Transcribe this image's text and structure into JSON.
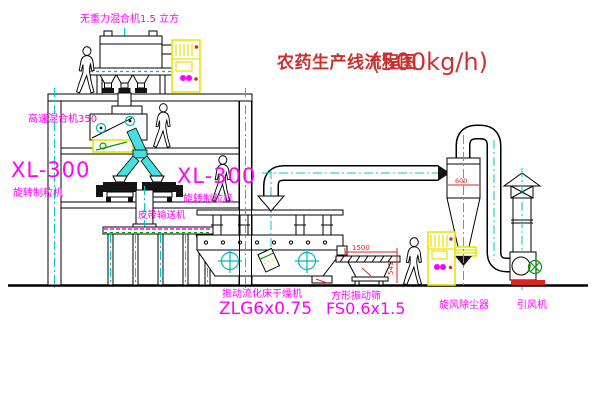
{
  "title": {
    "text": "农药生产线流程图",
    "capacity": "(500kg/h)"
  },
  "equipment": {
    "gravity_mixer_label": "无重力混合机1.5 立方",
    "high_speed_mixer_label": "高速混合机350",
    "granulator_left": {
      "model": "XL-300",
      "name": "旋转制粒机"
    },
    "granulator_right": {
      "model": "XL-300",
      "name": "旋转制粒机"
    },
    "belt_conveyor_label": "皮带输送机",
    "fluid_bed_dryer": {
      "name": "振动流化床干燥机",
      "model": "ZLG6x0.75"
    },
    "vibrating_screen": {
      "name": "方形振动筛",
      "model": "FS0.6x1.5"
    },
    "cyclone_label": "旋风除尘器",
    "fan_label": "引风机"
  },
  "dimensions": {
    "screen_length": "1500",
    "screen_height": "541",
    "cyclone_width": "600"
  },
  "icons": {
    "person": "person-silhouette-icon",
    "cabinet_symbol": "motor-coil-icon",
    "crosshair": "vibration-motor-crosshair-icon"
  },
  "colors": {
    "background": "#ffffff",
    "line": "#000000",
    "label_magenta": "#ff00ff",
    "title_red": "#cc3030",
    "dimension_red": "#e02222",
    "centerline_cyan": "#00c8c8",
    "chute_cyan": "#46dede",
    "cabinet_yellow": "#e8e400",
    "detail_green": "#00a000"
  }
}
